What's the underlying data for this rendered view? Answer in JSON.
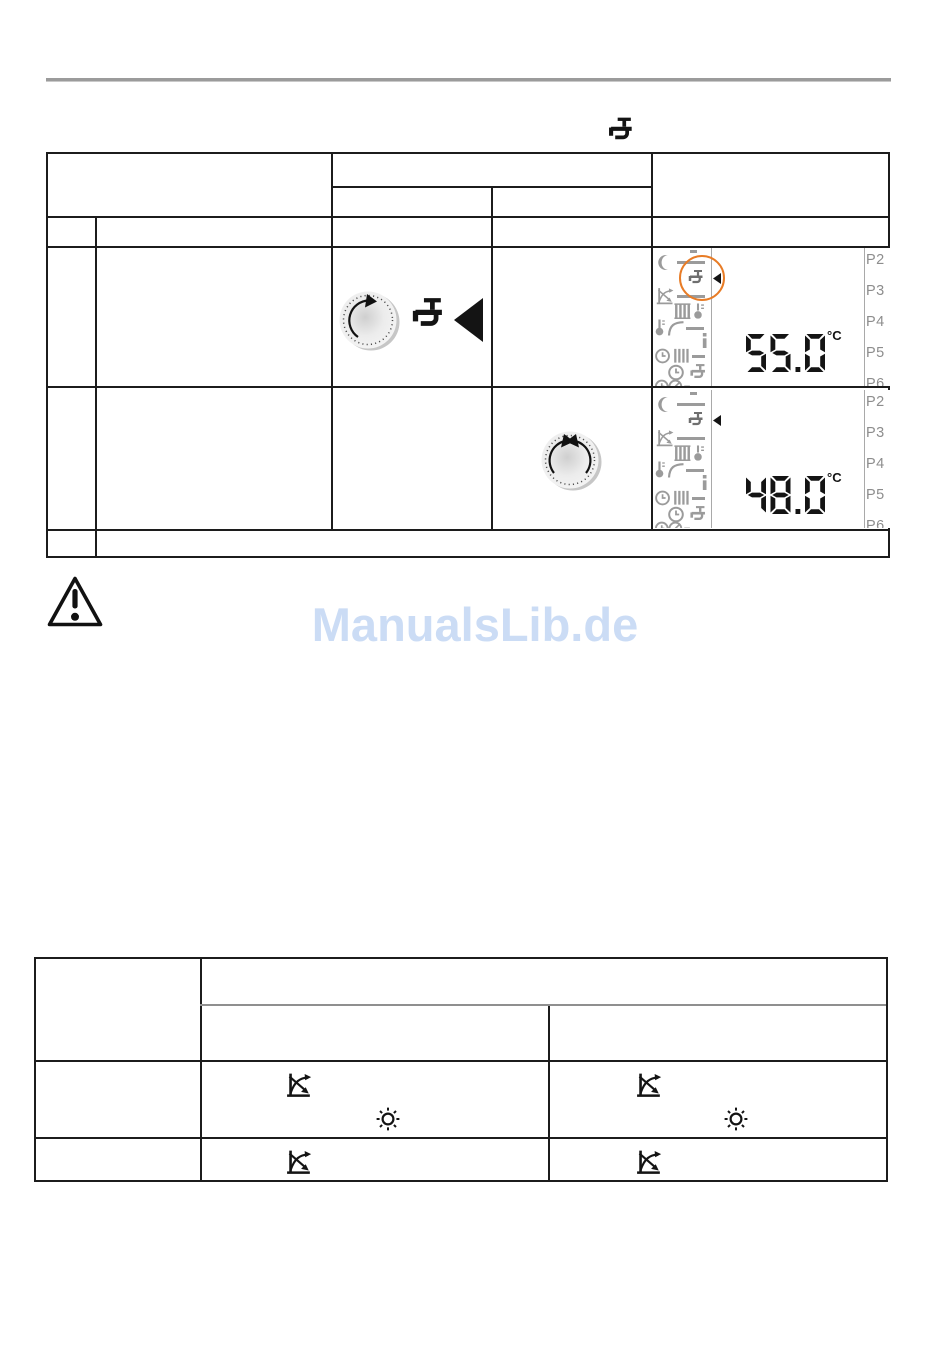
{
  "page": {
    "watermark_text": "ManualsLib.de"
  },
  "colors": {
    "highlight_orange": "#E87C26",
    "watermark_blue": "#CBDCF5",
    "lcd_icon_gray": "#9B9B9B",
    "table_border": "#1C1C1C"
  },
  "header": {
    "topic_icon": "faucet-dhw"
  },
  "table1": {
    "controls": {
      "row1_knob": "turn-clockwise",
      "row1_icons": [
        "faucet-dhw",
        "big-left-arrow"
      ],
      "row2_knob": "turn-both-directions"
    }
  },
  "lcd": {
    "unit": "°C",
    "program_labels": [
      "P2",
      "P3",
      "P4",
      "P5",
      "P6"
    ],
    "menu_icons": [
      "moon",
      "faucet",
      "heating-curve-off",
      "radiator-thermometer",
      "room-temperature",
      "info",
      "clock-radiator",
      "clock-faucet",
      "clock-gauge"
    ],
    "displays": [
      {
        "temperature": "55.0",
        "selected_icon": "faucet",
        "selection_marker": "left-triangle",
        "highlight_circle": true
      },
      {
        "temperature": "48.0",
        "selected_icon": "faucet",
        "selection_marker": "left-triangle",
        "highlight_circle": false
      }
    ]
  },
  "notice": {
    "icon": "warning-triangle"
  },
  "table2": {
    "cells": [
      {
        "row": 1,
        "col": 2,
        "icons": [
          "heating-curve-off",
          "sun"
        ]
      },
      {
        "row": 1,
        "col": 3,
        "icons": [
          "heating-curve-off",
          "sun"
        ]
      },
      {
        "row": 2,
        "col": 2,
        "icons": [
          "heating-curve-off"
        ]
      },
      {
        "row": 2,
        "col": 3,
        "icons": [
          "heating-curve-off"
        ]
      }
    ]
  }
}
